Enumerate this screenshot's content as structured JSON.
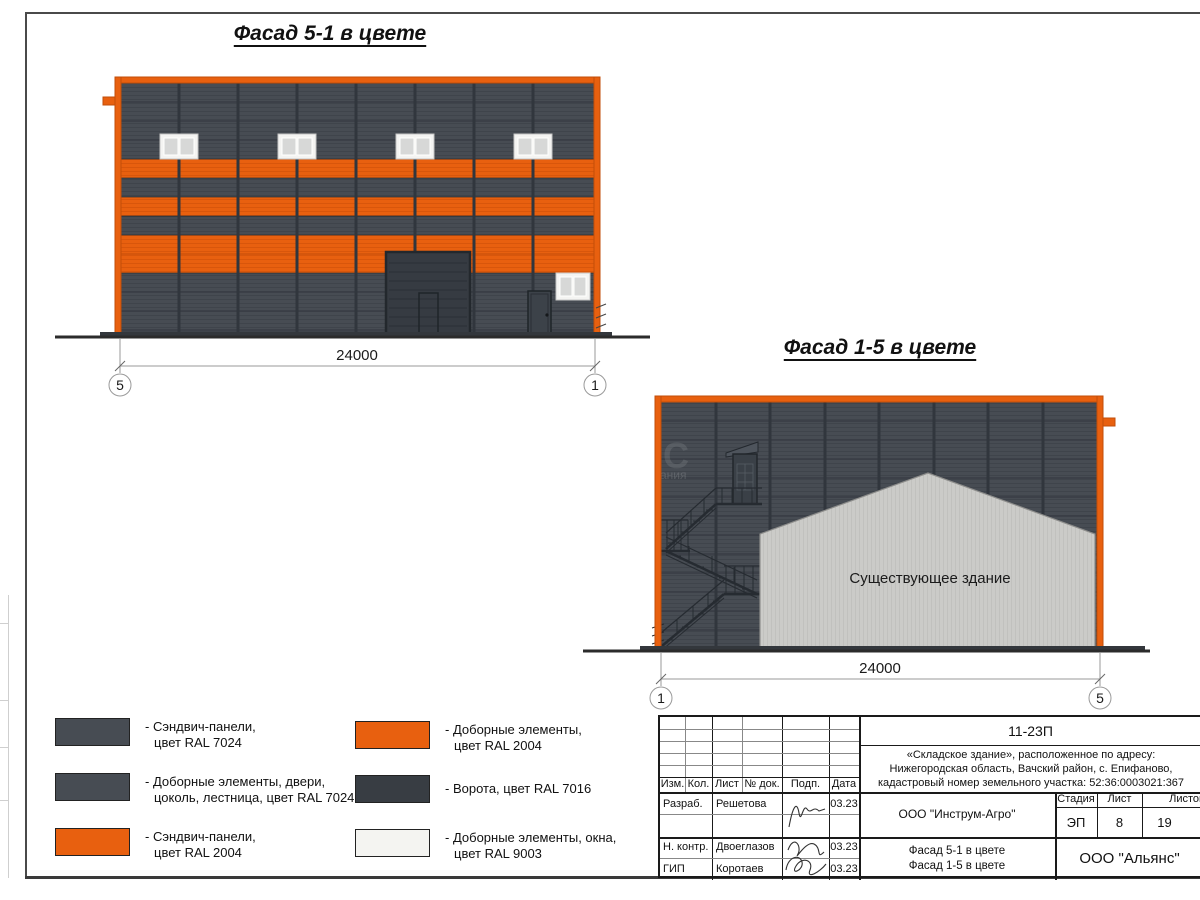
{
  "drawing": {
    "facade51": {
      "title": "Фасад 5-1 в цвете",
      "dimension": "24000",
      "axis_left": "5",
      "axis_right": "1"
    },
    "facade15": {
      "title": "Фасад 1-5 в цвете",
      "dimension": "24000",
      "axis_left": "1",
      "axis_right": "5",
      "existing_label": "Существующее здание",
      "watermark_big": "С",
      "watermark_small": "ания"
    }
  },
  "legend": {
    "items": [
      {
        "color": "#474C53",
        "line1": "- Сэндвич-панели,",
        "line2": "цвет RAL 7024"
      },
      {
        "color": "#474C53",
        "line1": "- Доборные элементы, двери,",
        "line2": "цоколь, лестница, цвет RAL 7024"
      },
      {
        "color": "#E8600F",
        "line1": "- Сэндвич-панели,",
        "line2": "цвет RAL 2004"
      },
      {
        "color": "#E8600F",
        "line1": "- Доборные элементы,",
        "line2": "цвет RAL 2004"
      },
      {
        "color": "#383D43",
        "line1": "- Ворота, цвет RAL 7016",
        "line2": ""
      },
      {
        "color": "#F4F4F1",
        "line1": "- Доборные элементы, окна,",
        "line2": "цвет RAL 9003"
      }
    ]
  },
  "titleblock": {
    "doc_number": "11-23П",
    "address_line1": "«Складское здание», расположенное по адресу:",
    "address_line2": "Нижегородская область, Вачский район, с. Епифаново,",
    "address_line3": "кадастровый номер земельного участка: 52:36:0003021:367",
    "h_izm": "Изм.",
    "h_kol": "Кол.",
    "h_list": "Лист",
    "h_doc": "№ док.",
    "h_sign": "Подп.",
    "h_date": "Дата",
    "r1_role": "Разраб.",
    "r1_name": "Решетова",
    "r1_date": "03.23",
    "r2_role": "Н. контр.",
    "r2_name": "Двоеглазов",
    "r2_date": "03.23",
    "r3_role": "ГИП",
    "r3_name": "Коротаев",
    "r3_date": "03.23",
    "customer": "ООО \"Инструм-Агро\"",
    "h_stage": "Стадия",
    "h_sheet": "Лист",
    "h_sheets": "Листов",
    "stage": "ЭП",
    "sheet": "8",
    "sheets": "19",
    "content_line1": "Фасад 5-1 в цвете",
    "content_line2": "Фасад 1-5 в цвете",
    "org": "ООО \"Альянс\""
  },
  "colors": {
    "ral7024_panels": "#474C53",
    "ral2004_elements": "#E8600F",
    "ral7016_gates": "#383D43",
    "ral9003_windows": "#F4F4F1",
    "existing_building": "#CBCBC8"
  }
}
